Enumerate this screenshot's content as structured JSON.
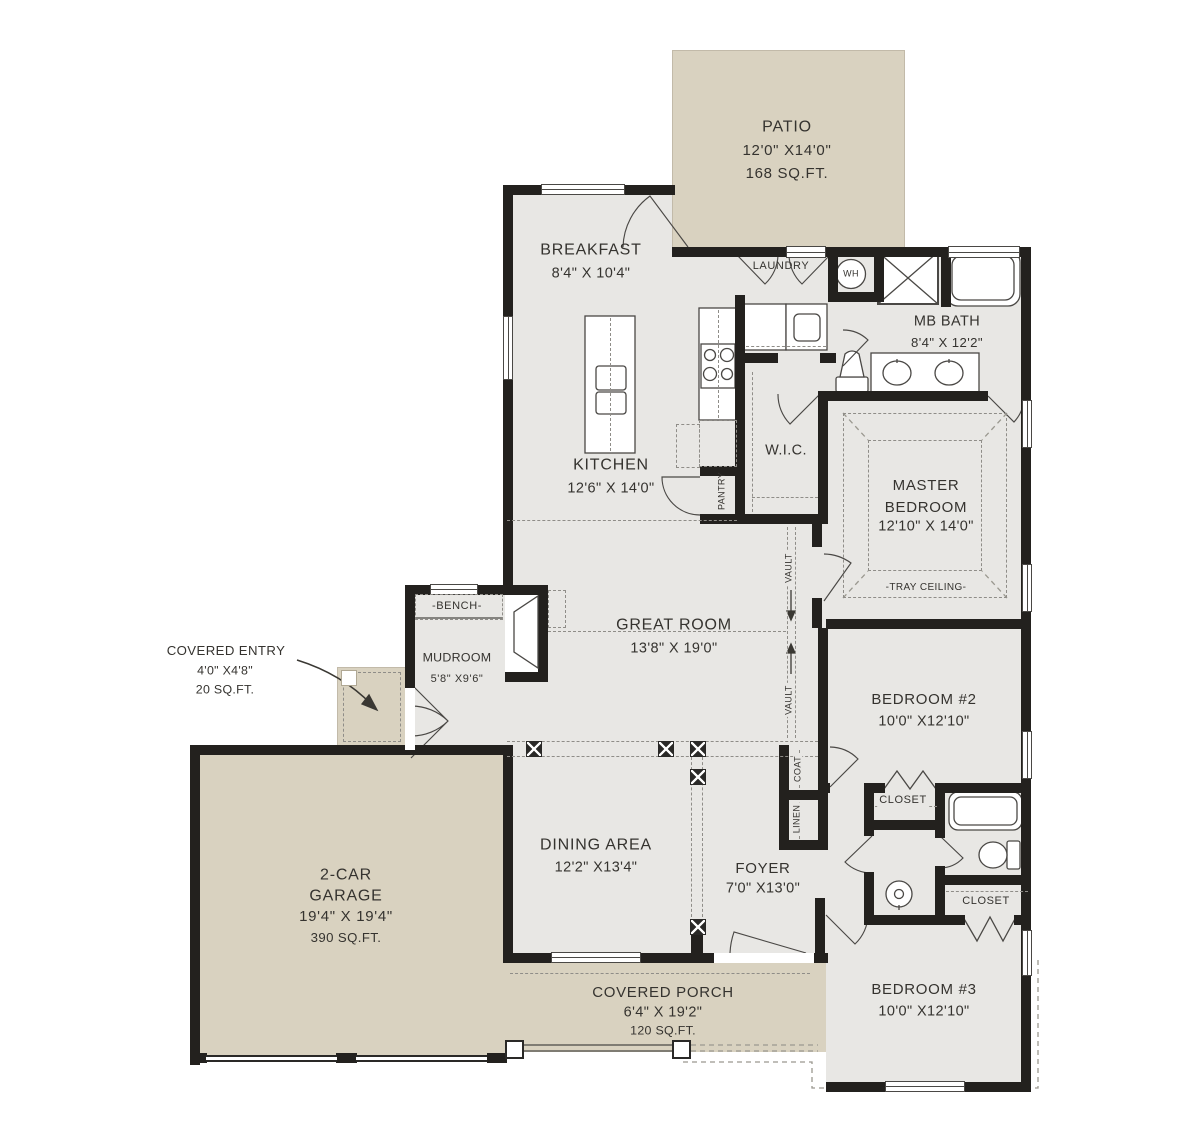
{
  "colors": {
    "floor": "#e8e7e4",
    "outdoor": "#d9d2c0",
    "wall": "#23211e",
    "ink": "#35332f",
    "dash": "#8f8d88"
  },
  "rooms": {
    "patio": {
      "name": "PATIO",
      "dims": "12'0\" X14'0\"",
      "area": "168 SQ.FT."
    },
    "breakfast": {
      "name": "BREAKFAST",
      "dims": "8'4\" X 10'4\""
    },
    "laundry": {
      "name": "LAUNDRY"
    },
    "water_heater": {
      "abbr": "WH"
    },
    "mb_bath": {
      "name": "MB BATH",
      "dims": "8'4\" X 12'2\""
    },
    "wic": {
      "name": "W.I.C."
    },
    "kitchen": {
      "name": "KITCHEN",
      "dims": "12'6\" X 14'0\""
    },
    "pantry": {
      "name": "PANTRY"
    },
    "master": {
      "name_line1": "MASTER",
      "name_line2": "BEDROOM",
      "dims": "12'10\" X 14'0\"",
      "note": "-TRAY CEILING-"
    },
    "great_room": {
      "name": "GREAT ROOM",
      "dims": "13'8\" X 19'0\""
    },
    "vault_label": "VAULT",
    "mudroom": {
      "name": "MUDROOM",
      "dims": "5'8\" X9'6\"",
      "bench": "-BENCH-"
    },
    "covered_entry": {
      "name": "COVERED ENTRY",
      "dims": "4'0\" X4'8\"",
      "area": "20 SQ.FT."
    },
    "garage": {
      "name_line1": "2-CAR",
      "name_line2": "GARAGE",
      "dims": "19'4\" X 19'4\"",
      "area": "390 SQ.FT."
    },
    "dining": {
      "name": "DINING AREA",
      "dims": "12'2\" X13'4\""
    },
    "foyer": {
      "name": "FOYER",
      "dims": "7'0\" X13'0\""
    },
    "coat": {
      "name": "COAT"
    },
    "linen": {
      "name": "LINEN"
    },
    "bedroom2": {
      "name": "BEDROOM #2",
      "dims": "10'0\" X12'10\"",
      "closet": "CLOSET"
    },
    "bedroom3": {
      "name": "BEDROOM #3",
      "dims": "10'0\" X12'10\"",
      "closet": "CLOSET"
    },
    "covered_porch": {
      "name": "COVERED PORCH",
      "dims": "6'4\" X 19'2\"",
      "area": "120 SQ.FT."
    }
  }
}
